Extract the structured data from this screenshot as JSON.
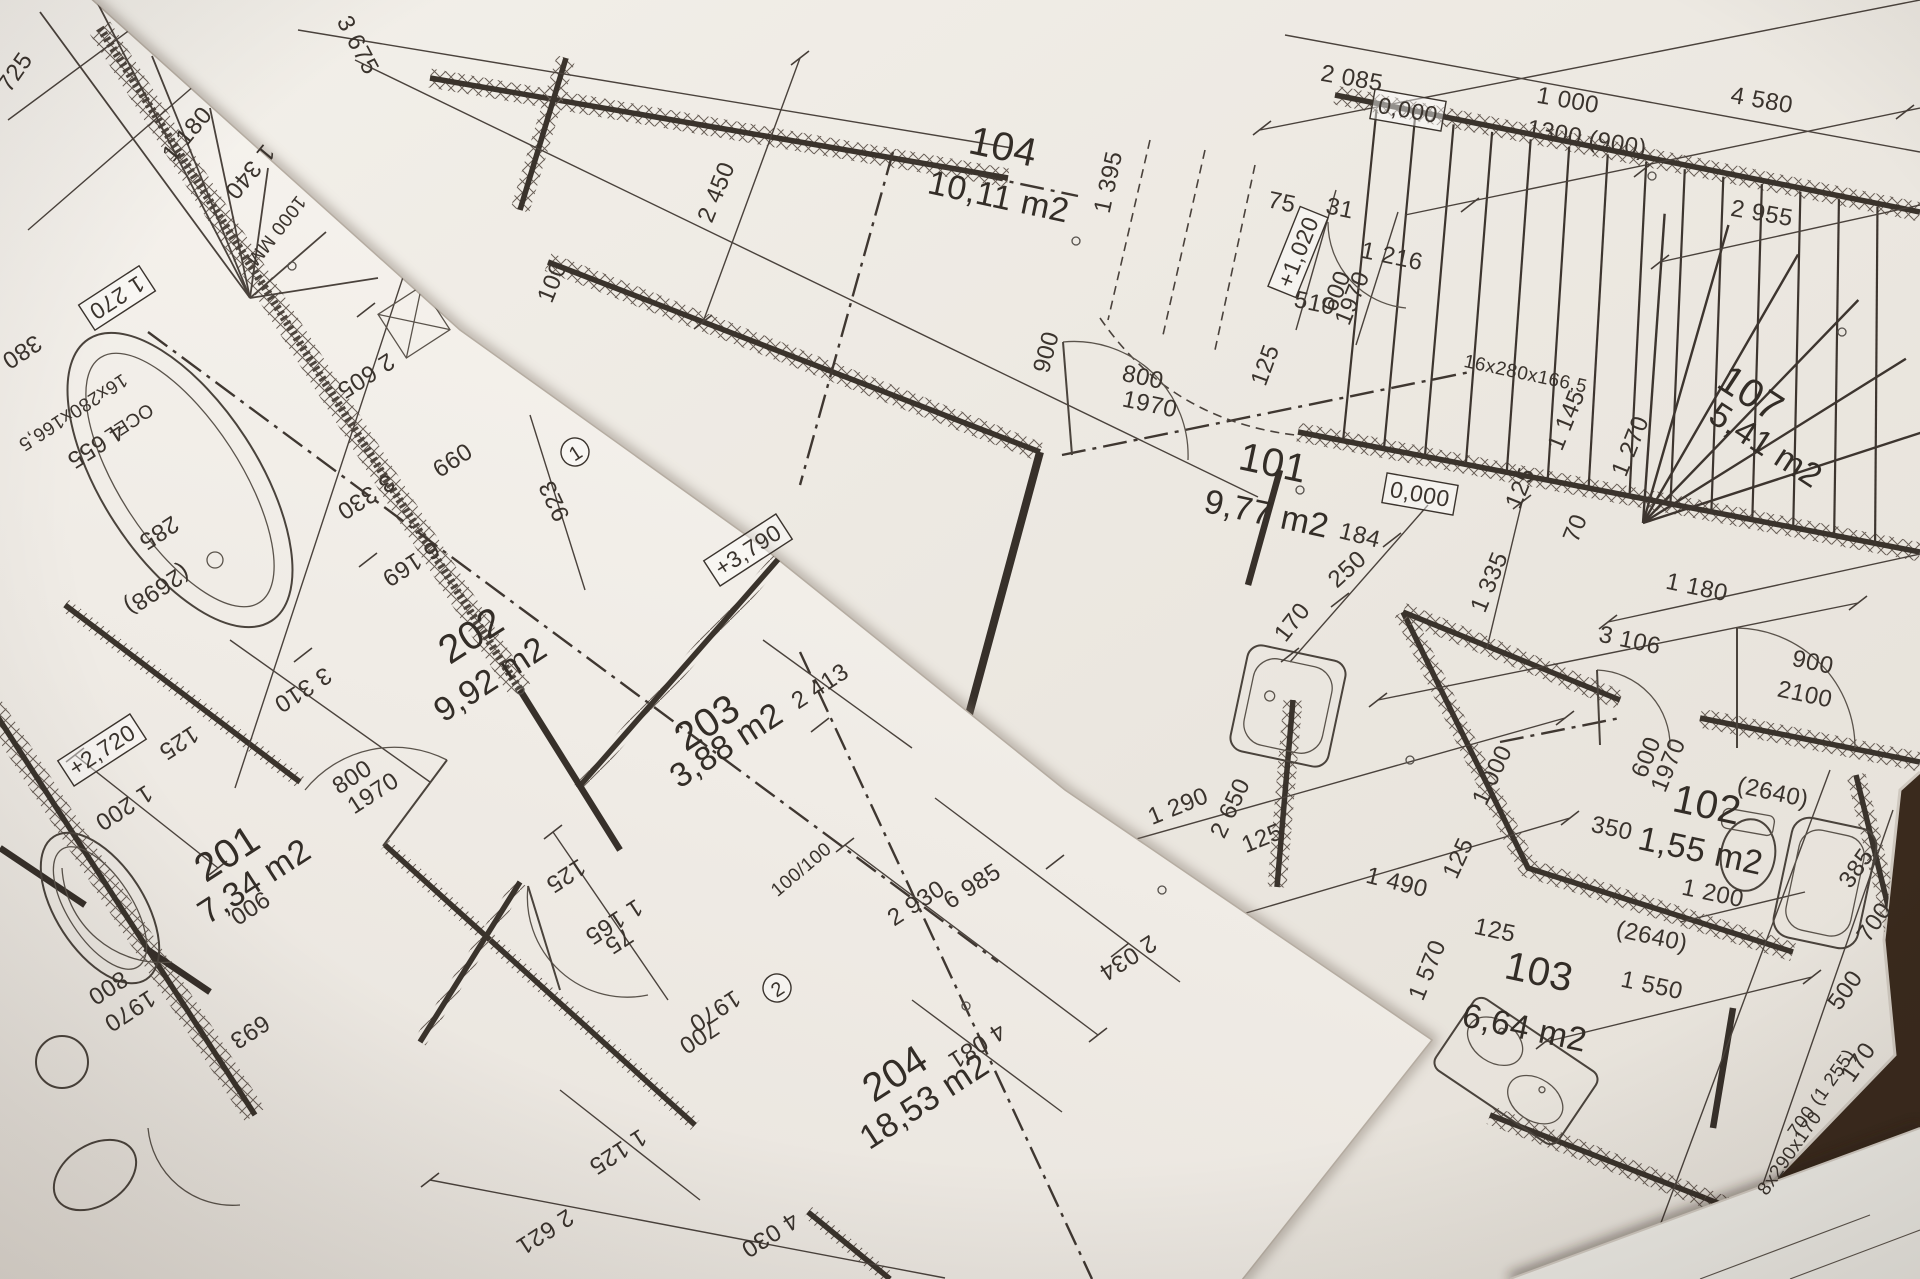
{
  "scene": {
    "description": "Photograph of overlapping architectural floor-plan blueprints on a table",
    "table_color": "#3f2d20",
    "paper_color_left": "#f6f3ee",
    "paper_color_right": "#f2efe9",
    "line_color": "#3a322c"
  },
  "rooms": [
    {
      "number": "101",
      "area": "9,77 m2"
    },
    {
      "number": "102",
      "area": "1,55 m2"
    },
    {
      "number": "103",
      "area": "6,64 m2"
    },
    {
      "number": "104",
      "area": "10,11 m2"
    },
    {
      "number": "107",
      "area": "5,41 m2"
    },
    {
      "number": "201",
      "area": "7,34 m2"
    },
    {
      "number": "202",
      "area": "9,92 m2"
    },
    {
      "number": "203",
      "area": "3,88 m2"
    },
    {
      "number": "204",
      "area": "18,53 m2"
    }
  ],
  "elevation_markers": [
    "0,000",
    "0,000",
    "+3,790",
    "+2,720",
    "+1,020"
  ],
  "stair_labels": [
    "16x280x166,5",
    "16x280x166,5",
    "8x290x170"
  ],
  "labels": [
    {
      "t": "2 085",
      "x": 1352,
      "y": 78,
      "r": 10,
      "s": "d"
    },
    {
      "t": "1 000",
      "x": 1568,
      "y": 100,
      "r": 10,
      "s": "d"
    },
    {
      "t": "1300 (900)",
      "x": 1587,
      "y": 138,
      "r": 10,
      "s": "d"
    },
    {
      "t": "4 580",
      "x": 1762,
      "y": 100,
      "r": 10,
      "s": "d"
    },
    {
      "t": "2 955",
      "x": 1762,
      "y": 213,
      "r": 10,
      "s": "d"
    },
    {
      "t": "3 675",
      "x": 358,
      "y": 45,
      "r": 62,
      "s": "d"
    },
    {
      "t": "2 450",
      "x": 716,
      "y": 192,
      "r": -68,
      "s": "d"
    },
    {
      "t": "100",
      "x": 552,
      "y": 282,
      "r": -68,
      "s": "d"
    },
    {
      "t": "104",
      "x": 1002,
      "y": 152,
      "r": 12,
      "s": "n"
    },
    {
      "t": "10,11 m2",
      "x": 998,
      "y": 200,
      "r": 12,
      "s": "a"
    },
    {
      "t": "1 395",
      "x": 1108,
      "y": 182,
      "r": -78,
      "s": "d"
    },
    {
      "t": "75",
      "x": 1282,
      "y": 202,
      "r": 12,
      "s": "d"
    },
    {
      "t": "31",
      "x": 1340,
      "y": 208,
      "r": 12,
      "s": "d"
    },
    {
      "t": "+1,020",
      "x": 1298,
      "y": 252,
      "r": -68,
      "s": "b"
    },
    {
      "t": "510",
      "x": 1315,
      "y": 303,
      "r": 12,
      "s": "d"
    },
    {
      "t": "600",
      "x": 1336,
      "y": 291,
      "r": -68,
      "s": "d"
    },
    {
      "t": "1970",
      "x": 1352,
      "y": 298,
      "r": -68,
      "s": "d"
    },
    {
      "t": "1 216",
      "x": 1392,
      "y": 256,
      "r": 12,
      "s": "d"
    },
    {
      "t": "16x280x166,5",
      "x": 1526,
      "y": 372,
      "r": 12,
      "s": "ds"
    },
    {
      "t": "1 145",
      "x": 1566,
      "y": 420,
      "r": -68,
      "s": "d"
    },
    {
      "t": "1 270",
      "x": 1630,
      "y": 446,
      "r": -68,
      "s": "d"
    },
    {
      "t": "125",
      "x": 1520,
      "y": 488,
      "r": -68,
      "s": "d"
    },
    {
      "t": "70",
      "x": 1575,
      "y": 528,
      "r": -68,
      "s": "d"
    },
    {
      "t": "107",
      "x": 1748,
      "y": 398,
      "r": 33,
      "s": "n"
    },
    {
      "t": "5,41 m2",
      "x": 1764,
      "y": 448,
      "r": 33,
      "s": "a"
    },
    {
      "t": "0,000",
      "x": 1408,
      "y": 110,
      "r": 10,
      "s": "b"
    },
    {
      "t": "0,000",
      "x": 1420,
      "y": 494,
      "r": 10,
      "s": "b"
    },
    {
      "t": "101",
      "x": 1272,
      "y": 468,
      "r": 12,
      "s": "n"
    },
    {
      "t": "9,77 m2",
      "x": 1266,
      "y": 517,
      "r": 12,
      "s": "a"
    },
    {
      "t": "800",
      "x": 1143,
      "y": 377,
      "r": 12,
      "s": "d"
    },
    {
      "t": "1970",
      "x": 1150,
      "y": 404,
      "r": 12,
      "s": "d"
    },
    {
      "t": "900",
      "x": 1046,
      "y": 352,
      "r": -75,
      "s": "d"
    },
    {
      "t": "184",
      "x": 1360,
      "y": 535,
      "r": 14,
      "s": "d"
    },
    {
      "t": "250",
      "x": 1347,
      "y": 569,
      "r": -42,
      "s": "d"
    },
    {
      "t": "170",
      "x": 1292,
      "y": 622,
      "r": -52,
      "s": "d"
    },
    {
      "t": "125",
      "x": 1265,
      "y": 365,
      "r": -70,
      "s": "d"
    },
    {
      "t": "1 335",
      "x": 1489,
      "y": 582,
      "r": -68,
      "s": "d"
    },
    {
      "t": "3 106",
      "x": 1630,
      "y": 640,
      "r": 12,
      "s": "d"
    },
    {
      "t": "1 180",
      "x": 1697,
      "y": 587,
      "r": 12,
      "s": "d"
    },
    {
      "t": "900",
      "x": 1813,
      "y": 662,
      "r": 12,
      "s": "d"
    },
    {
      "t": "2100",
      "x": 1805,
      "y": 694,
      "r": 12,
      "s": "d"
    },
    {
      "t": "1 290",
      "x": 1178,
      "y": 806,
      "r": -22,
      "s": "d"
    },
    {
      "t": "2 650",
      "x": 1230,
      "y": 808,
      "r": -65,
      "s": "d"
    },
    {
      "t": "125",
      "x": 1262,
      "y": 838,
      "r": -22,
      "s": "d"
    },
    {
      "t": "1 490",
      "x": 1397,
      "y": 882,
      "r": 14,
      "s": "d"
    },
    {
      "t": "125",
      "x": 1458,
      "y": 858,
      "r": -65,
      "s": "d"
    },
    {
      "t": "1 000",
      "x": 1492,
      "y": 775,
      "r": -65,
      "s": "d"
    },
    {
      "t": "600",
      "x": 1646,
      "y": 757,
      "r": -68,
      "s": "d"
    },
    {
      "t": "1970",
      "x": 1668,
      "y": 765,
      "r": -68,
      "s": "d"
    },
    {
      "t": "(2640)",
      "x": 1773,
      "y": 792,
      "r": 12,
      "s": "d"
    },
    {
      "t": "102",
      "x": 1706,
      "y": 810,
      "r": 12,
      "s": "n"
    },
    {
      "t": "1,55 m2",
      "x": 1700,
      "y": 854,
      "r": 12,
      "s": "a"
    },
    {
      "t": "350",
      "x": 1612,
      "y": 828,
      "r": 12,
      "s": "d"
    },
    {
      "t": "1 200",
      "x": 1713,
      "y": 893,
      "r": 12,
      "s": "d"
    },
    {
      "t": "(2640)",
      "x": 1652,
      "y": 936,
      "r": 12,
      "s": "d"
    },
    {
      "t": "385",
      "x": 1856,
      "y": 868,
      "r": -55,
      "s": "d"
    },
    {
      "t": "700",
      "x": 1874,
      "y": 922,
      "r": -55,
      "s": "d"
    },
    {
      "t": "103",
      "x": 1538,
      "y": 977,
      "r": 12,
      "s": "n"
    },
    {
      "t": "6,64 m2",
      "x": 1524,
      "y": 1031,
      "r": 12,
      "s": "a"
    },
    {
      "t": "1 570",
      "x": 1427,
      "y": 970,
      "r": -68,
      "s": "d"
    },
    {
      "t": "125",
      "x": 1495,
      "y": 930,
      "r": 12,
      "s": "d"
    },
    {
      "t": "1 550",
      "x": 1652,
      "y": 985,
      "r": 12,
      "s": "d"
    },
    {
      "t": "500",
      "x": 1845,
      "y": 990,
      "r": -55,
      "s": "d"
    },
    {
      "t": "170",
      "x": 1858,
      "y": 1062,
      "r": -55,
      "s": "d"
    },
    {
      "t": "700 (1 255)",
      "x": 1820,
      "y": 1092,
      "r": -55,
      "s": "ds"
    },
    {
      "t": "8x290x170",
      "x": 1788,
      "y": 1152,
      "r": -55,
      "s": "ds"
    },
    {
      "t": "2 034",
      "x": 1128,
      "y": 958,
      "r": 147,
      "s": "d"
    },
    {
      "t": "725",
      "x": 15,
      "y": 72,
      "r": -55,
      "s": "d"
    },
    {
      "t": "1 180",
      "x": 187,
      "y": 134,
      "r": -50,
      "s": "d"
    },
    {
      "t": "1 340",
      "x": 250,
      "y": 172,
      "r": 130,
      "s": "d"
    },
    {
      "t": "1000 MM",
      "x": 278,
      "y": 232,
      "r": 128,
      "s": "ds"
    },
    {
      "t": "1 270",
      "x": 117,
      "y": 298,
      "r": 147,
      "s": "b"
    },
    {
      "t": "380",
      "x": 22,
      "y": 352,
      "r": 147,
      "s": "d"
    },
    {
      "t": "16x280x166,5",
      "x": 74,
      "y": 414,
      "r": 147,
      "s": "ds"
    },
    {
      "t": "4 655",
      "x": 96,
      "y": 446,
      "r": 147,
      "s": "d"
    },
    {
      "t": "OCEL",
      "x": 130,
      "y": 424,
      "r": 147,
      "s": "ds"
    },
    {
      "t": "285",
      "x": 159,
      "y": 533,
      "r": 147,
      "s": "d"
    },
    {
      "t": "(2698)",
      "x": 157,
      "y": 590,
      "r": 147,
      "s": "d"
    },
    {
      "t": "2 605",
      "x": 366,
      "y": 376,
      "r": 147,
      "s": "d"
    },
    {
      "t": "3 330",
      "x": 366,
      "y": 497,
      "r": 147,
      "s": "d"
    },
    {
      "t": "6 169",
      "x": 411,
      "y": 564,
      "r": 147,
      "s": "d"
    },
    {
      "t": "099",
      "x": 452,
      "y": 460,
      "r": 147,
      "s": "d"
    },
    {
      "t": "923",
      "x": 554,
      "y": 501,
      "r": -115,
      "s": "d"
    },
    {
      "t": "1",
      "x": 575,
      "y": 452,
      "r": -33,
      "s": "c"
    },
    {
      "t": "202",
      "x": 474,
      "y": 640,
      "r": -33,
      "s": "n"
    },
    {
      "t": "9,92 m2",
      "x": 492,
      "y": 682,
      "r": -33,
      "s": "a"
    },
    {
      "t": "3 310",
      "x": 303,
      "y": 690,
      "r": 147,
      "s": "d"
    },
    {
      "t": "+3,790",
      "x": 748,
      "y": 550,
      "r": -33,
      "s": "b"
    },
    {
      "t": "203",
      "x": 710,
      "y": 727,
      "r": -33,
      "s": "n"
    },
    {
      "t": "3,88 m2",
      "x": 728,
      "y": 748,
      "r": -33,
      "s": "a"
    },
    {
      "t": "2 413",
      "x": 820,
      "y": 686,
      "r": -33,
      "s": "d"
    },
    {
      "t": "+2,720",
      "x": 102,
      "y": 750,
      "r": -33,
      "s": "b"
    },
    {
      "t": "125",
      "x": 179,
      "y": 743,
      "r": 147,
      "s": "d"
    },
    {
      "t": "1 200",
      "x": 124,
      "y": 808,
      "r": 147,
      "s": "d"
    },
    {
      "t": "800",
      "x": 352,
      "y": 777,
      "r": -33,
      "s": "d"
    },
    {
      "t": "1970",
      "x": 373,
      "y": 793,
      "r": -33,
      "s": "d"
    },
    {
      "t": "201",
      "x": 230,
      "y": 858,
      "r": -33,
      "s": "n"
    },
    {
      "t": "7,34 m2",
      "x": 256,
      "y": 884,
      "r": -33,
      "s": "a"
    },
    {
      "t": "1 165",
      "x": 614,
      "y": 922,
      "r": 147,
      "s": "d"
    },
    {
      "t": "125",
      "x": 566,
      "y": 876,
      "r": 147,
      "s": "d"
    },
    {
      "t": "75",
      "x": 619,
      "y": 941,
      "r": 147,
      "s": "d"
    },
    {
      "t": "700",
      "x": 699,
      "y": 1037,
      "r": 147,
      "s": "d"
    },
    {
      "t": "1970",
      "x": 715,
      "y": 1011,
      "r": 147,
      "s": "d"
    },
    {
      "t": "100/100",
      "x": 800,
      "y": 868,
      "r": -40,
      "s": "ds"
    },
    {
      "t": "2",
      "x": 777,
      "y": 988,
      "r": -33,
      "s": "c"
    },
    {
      "t": "2 930",
      "x": 916,
      "y": 903,
      "r": -33,
      "s": "d"
    },
    {
      "t": "6 985",
      "x": 972,
      "y": 886,
      "r": -33,
      "s": "d"
    },
    {
      "t": "204",
      "x": 898,
      "y": 1078,
      "r": -33,
      "s": "n"
    },
    {
      "t": "18,53 m2",
      "x": 926,
      "y": 1104,
      "r": -33,
      "s": "a"
    },
    {
      "t": "4 081",
      "x": 977,
      "y": 1046,
      "r": 147,
      "s": "d"
    },
    {
      "t": "4 030",
      "x": 770,
      "y": 1235,
      "r": 147,
      "s": "d"
    },
    {
      "t": "2 621",
      "x": 545,
      "y": 1232,
      "r": 147,
      "s": "d"
    },
    {
      "t": "1 125",
      "x": 618,
      "y": 1152,
      "r": 147,
      "s": "d"
    },
    {
      "t": "900",
      "x": 250,
      "y": 908,
      "r": 147,
      "s": "d"
    },
    {
      "t": "693",
      "x": 250,
      "y": 1032,
      "r": 147,
      "s": "d"
    },
    {
      "t": "800",
      "x": 108,
      "y": 988,
      "r": 147,
      "s": "d"
    },
    {
      "t": "1970",
      "x": 130,
      "y": 1011,
      "r": 147,
      "s": "d"
    }
  ]
}
